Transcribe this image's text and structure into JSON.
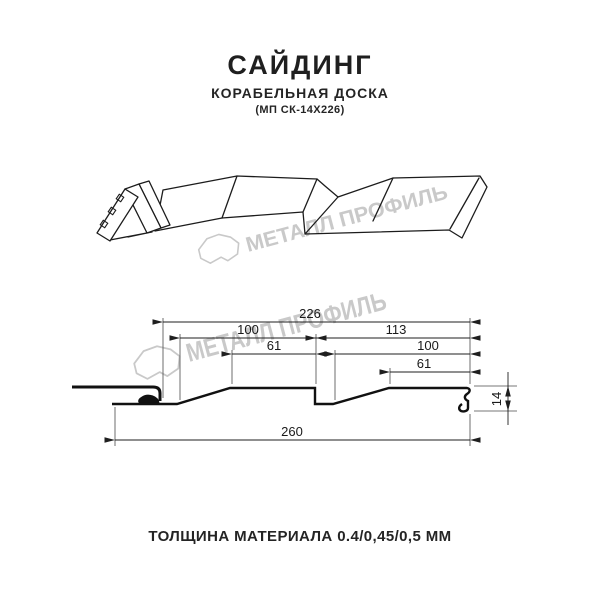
{
  "header": {
    "title": "САЙДИНГ",
    "subtitle": "КОРАБЕЛЬНАЯ ДОСКА",
    "model": "(МП СК-14Х226)"
  },
  "watermark": {
    "text": "МЕТАЛЛ ПРОФИЛЬ",
    "color": "#c9c9c9"
  },
  "drawing": {
    "kind": "siding panel profile — perspective view and cross-section",
    "units": "mm",
    "dims": {
      "module_width": "226",
      "left_panel": "100",
      "right_panel": "113",
      "left_flat": "61",
      "right_inner": "100",
      "right_flat": "61",
      "total_width": "260",
      "profile_height": "14"
    }
  },
  "footer": {
    "thickness_label": "ТОЛЩИНА МАТЕРИАЛА 0.4/0,45/0,5 ММ"
  },
  "colors": {
    "line": "#1c1c1c",
    "text": "#242424",
    "watermark": "#c9c9c9",
    "background": "#ffffff"
  }
}
